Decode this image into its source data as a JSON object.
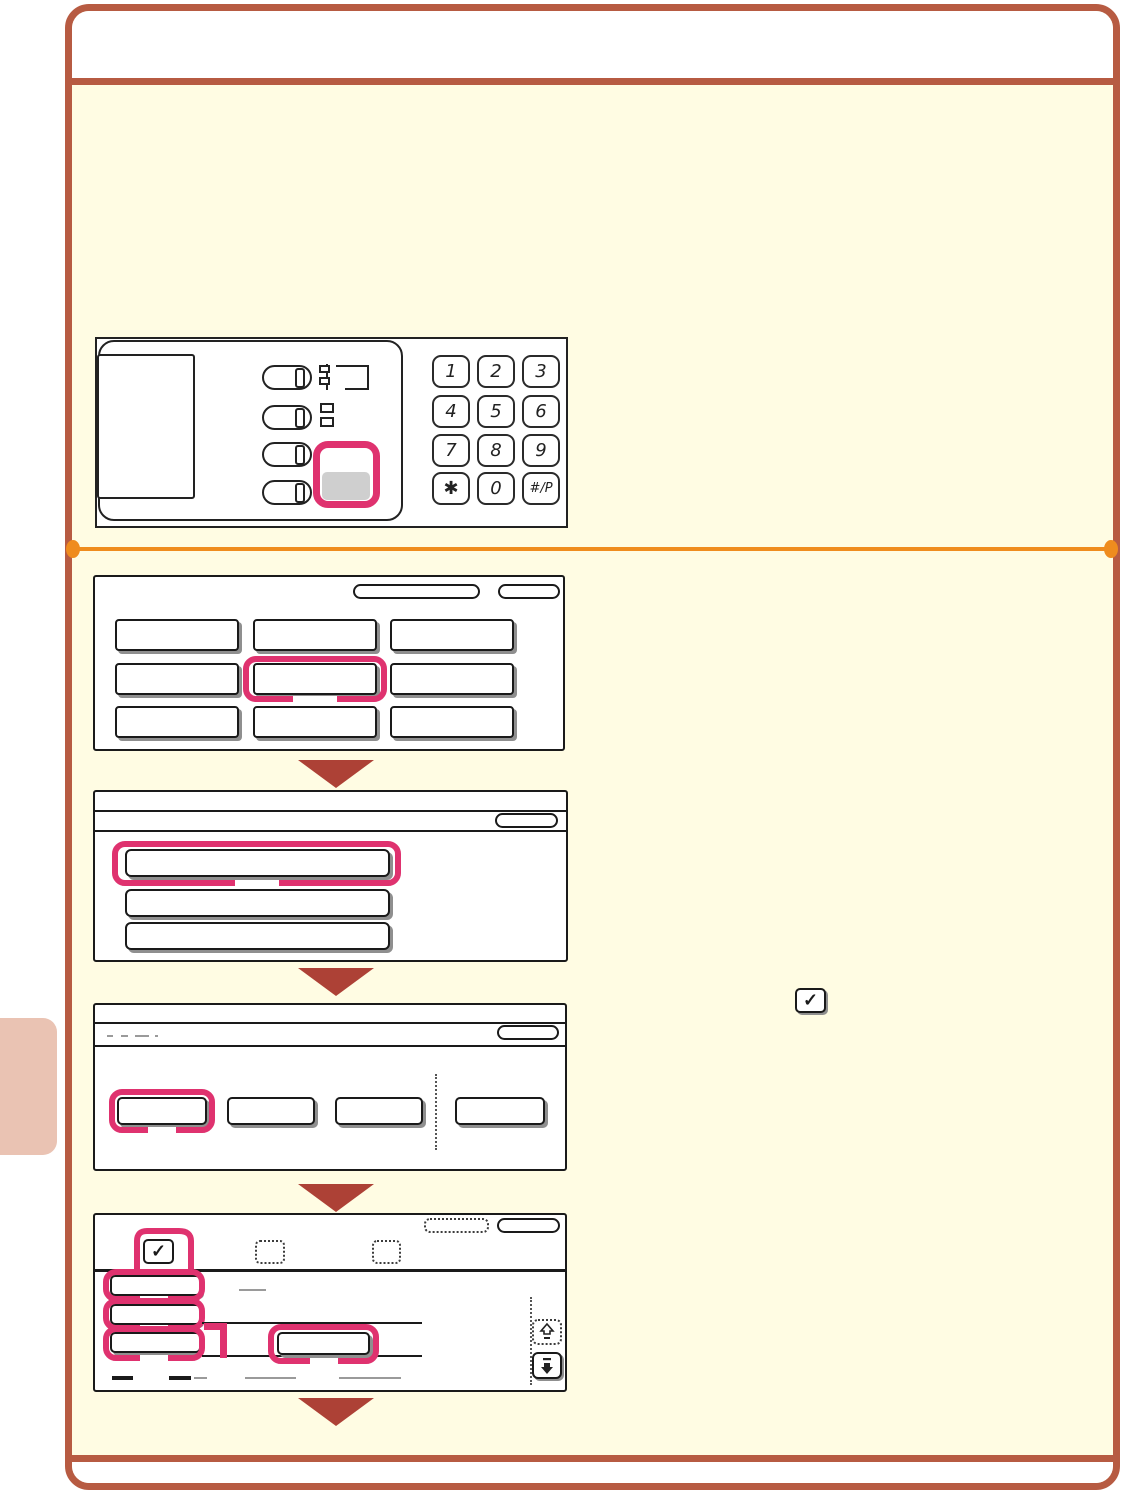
{
  "page": {
    "kind": "copier-quick-guide-step-page",
    "visible_text_note": "illustration-only page; UI buttons are blank"
  },
  "colors": {
    "frame_border": "#b75b42",
    "content_bg": "#fffce3",
    "header_bg": "#ffffff",
    "divider_orange": "#ef8c1e",
    "step_arrow_red": "#ad4136",
    "highlight_pink": "#df326f",
    "side_tab": "#eac3b3",
    "gray_key_fill": "#cfcfcf",
    "button_shadow": "#8f8f8f"
  },
  "control_panel": {
    "keypad_keys": [
      "1",
      "2",
      "3",
      "4",
      "5",
      "6",
      "7",
      "8",
      "9",
      "✱",
      "0",
      "#/P"
    ],
    "mode_button_count": 4,
    "highlighted_key": "settings-key"
  },
  "glyphs": {
    "check": "✓"
  },
  "steps": {
    "screen1": {
      "grid_button_count": 9,
      "highlighted": "row2-col2"
    },
    "screen2": {
      "list_button_count": 3,
      "highlighted": "row1"
    },
    "screen3": {
      "tab_button_count": 4,
      "highlighted": "tab1"
    },
    "screen4": {
      "checkbox_count": 3,
      "checked_checkbox": 1,
      "left_button_count": 3,
      "highlighted": "left-buttons-and-center-button"
    }
  }
}
